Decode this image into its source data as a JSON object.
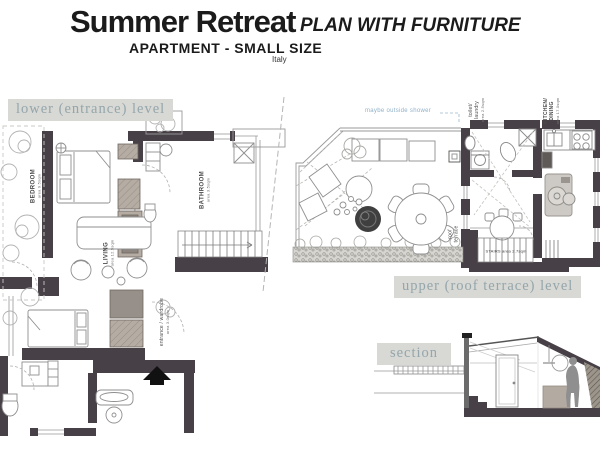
{
  "header": {
    "title": "Summer Retreat",
    "tagline": "PLAN WITH FURNITURE",
    "subtitle": "APARTMENT - SMALL SIZE",
    "country": "Italy"
  },
  "plans": {
    "lower": {
      "label": "lower (entrance) level"
    },
    "upper": {
      "label": "upper (roof terrace) level"
    },
    "section": {
      "label": "section"
    }
  },
  "lower_rooms": {
    "bedroom": {
      "name": "BEDROOM",
      "area": "area 9.5sqm"
    },
    "living": {
      "name": "LIVING",
      "area": "area 12.5sqm"
    },
    "bathroom": {
      "name": "BATHROOM",
      "area": "area 3.5sqm"
    },
    "entrance": {
      "name": "entrance / wardrobe",
      "area": "area 3.0sqm"
    }
  },
  "upper_rooms": {
    "toilet": {
      "line1": "toilet/",
      "line2": "laundry",
      "area": "area 2.5sqm"
    },
    "kitchen": {
      "line1": "KITCHEN/",
      "line2": "DINING",
      "area": "area 17.0sqm"
    },
    "terrace": {
      "line1": "roof",
      "line2": "terrace"
    },
    "stairs": {
      "label": "STAIRS area 2.7sqm"
    },
    "note": {
      "text": "maybe outside shower"
    }
  },
  "colors": {
    "wall": "#474046",
    "band_background": "#d8d8d4",
    "band_text": "#94a6ac",
    "furniture_tan": "#b5aca3",
    "note_blue": "#8fb0c8",
    "line_gray": "#8f8f8f"
  }
}
